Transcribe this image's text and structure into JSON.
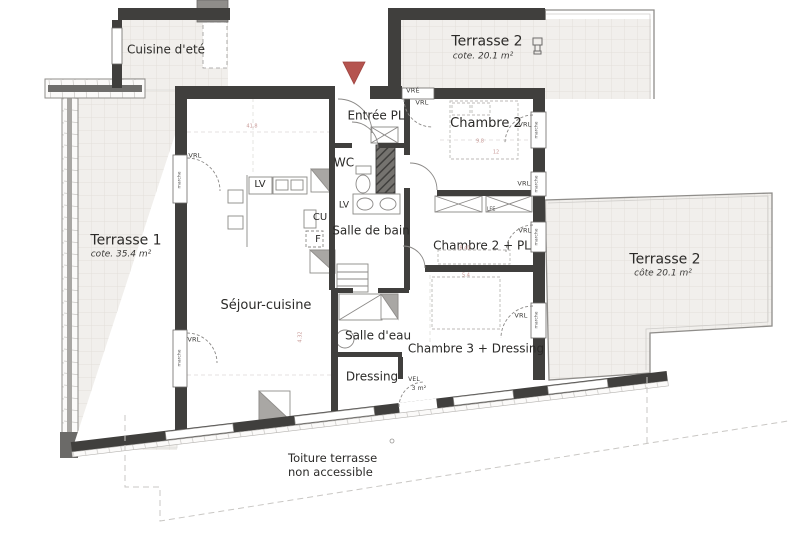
{
  "plan": {
    "rooms": {
      "cuisine": {
        "label": "Cuisine d'eté"
      },
      "terrasse1": {
        "label": "Terrasse 1",
        "area": "cote. 35.4 m²"
      },
      "terrasse2_top": {
        "label": "Terrasse 2",
        "area": "cote. 20.1 m²"
      },
      "terrasse2_right": {
        "label": "Terrasse 2",
        "area": "côte 20.1 m²"
      },
      "entree": {
        "label": "Entrée PL"
      },
      "chambre2": {
        "label": "Chambre 2"
      },
      "wc": {
        "label": "WC"
      },
      "salle_de_bain": {
        "label": "Salle de bain"
      },
      "chambre2_pl": {
        "label": "Chambre 2 + PL"
      },
      "sejour": {
        "label": "Séjour-cuisine"
      },
      "salle_eau": {
        "label": "Salle d'eau"
      },
      "chambre3": {
        "label": "Chambre 3 + Dressing"
      },
      "dressing": {
        "label": "Dressing"
      },
      "toiture": {
        "line1": "Toiture terrasse",
        "line2": "non accessible"
      }
    },
    "fixtures": {
      "lv_kitchen": "LV",
      "lv_bath": "LV",
      "cu": "CU",
      "f": "F",
      "lfe": "LFE"
    },
    "marks": {
      "vrl": "VRL",
      "vre": "VRÉ",
      "vel": "VEL",
      "vel_area": "3 m²",
      "marche": "marche"
    },
    "dims": {
      "sejour_w": "41.8",
      "ch2_a": "9.8",
      "ch2_b": "12",
      "sdb": "8.41",
      "sde": "5.4",
      "sejour_h": "4.32"
    },
    "colors": {
      "wall": "#403f3d",
      "entrance_marker": "#b5544f",
      "tile_bg": "#f1efec",
      "tile_line": "#e2dfda",
      "dim_text": "#c89a97"
    }
  }
}
